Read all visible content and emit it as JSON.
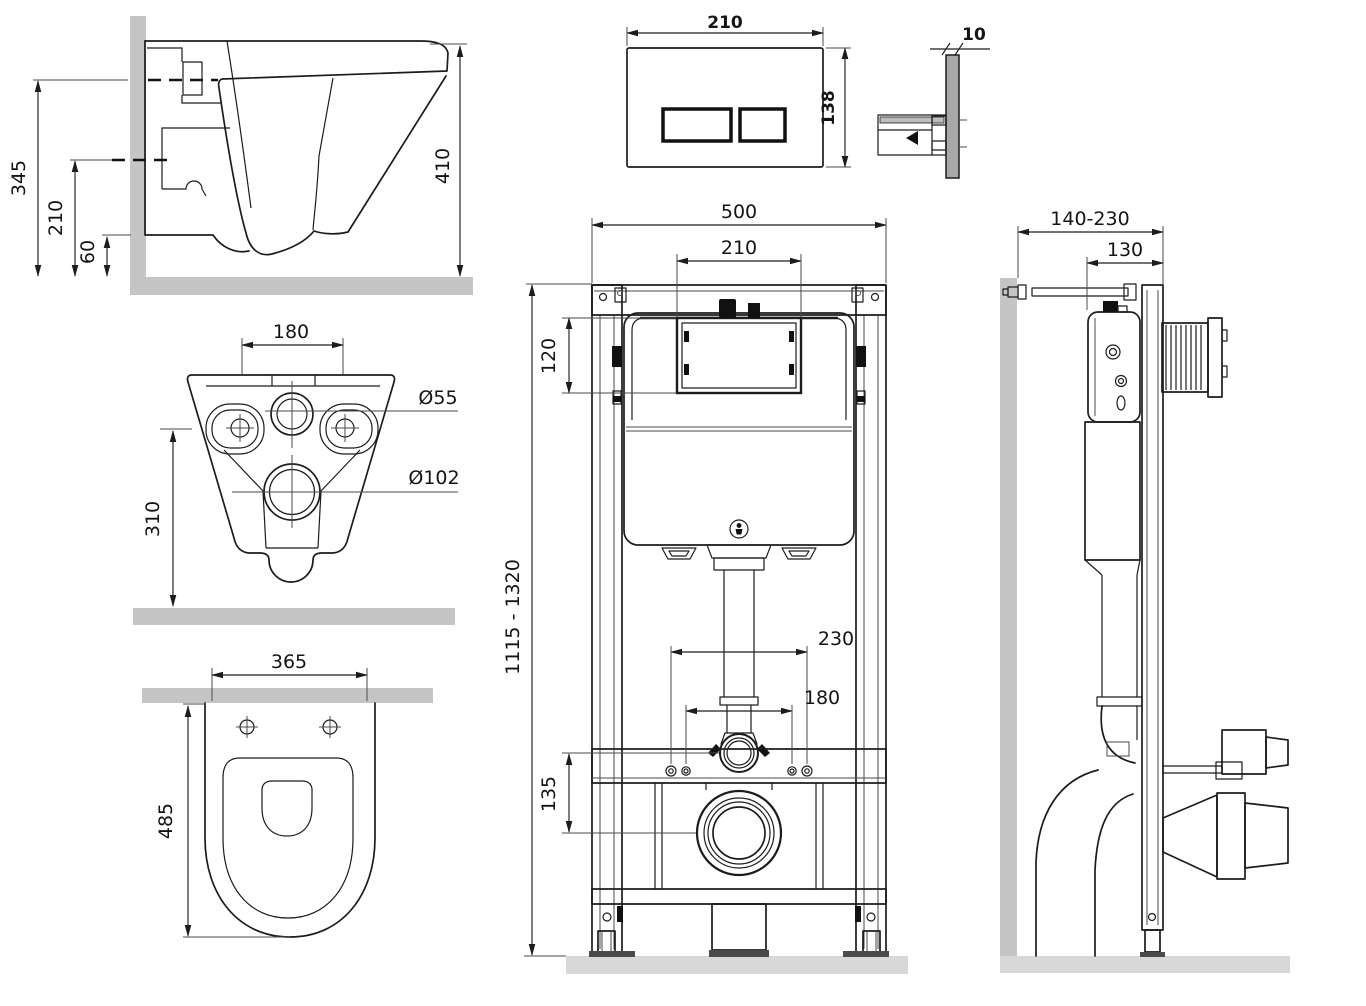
{
  "figure": {
    "type": "technical installation drawing",
    "subject": "wall-hung toilet with concealed cistern installation frame and flush plate",
    "units": "mm"
  },
  "colors": {
    "line": "#1c1c1c",
    "wall_gray": "#c5c5c5",
    "floor_gray": "#d8d8d8",
    "black_parts": "#111111"
  },
  "views": {
    "toilet_side": {
      "name": "toilet side section",
      "dims": {
        "overall_height": "345",
        "inlet_height": "210",
        "outlet_height": "60",
        "depth": "410"
      }
    },
    "toilet_back": {
      "name": "toilet rear view",
      "dims": {
        "bolt_spacing": "180",
        "inlet_diameter": "Ø55",
        "outlet_diameter": "Ø102",
        "mount_height": "310"
      }
    },
    "toilet_top": {
      "name": "toilet top view",
      "dims": {
        "width": "365",
        "depth": "485"
      }
    },
    "flush_plate_front": {
      "name": "flush plate front view",
      "dims": {
        "width": "210",
        "height": "138"
      }
    },
    "flush_plate_side": {
      "name": "flush plate side view",
      "dims": {
        "thickness": "10"
      }
    },
    "frame_front": {
      "name": "installation frame front view",
      "dims": {
        "frame_width": "500",
        "opening_width": "210",
        "opening_height": "120",
        "height_range": "1115 - 1320",
        "outer_hole_spacing": "230",
        "inner_hole_spacing": "180",
        "drain_offset": "135"
      }
    },
    "frame_side": {
      "name": "installation frame side view",
      "dims": {
        "wall_distance_range": "140-230",
        "frame_depth": "130"
      }
    }
  }
}
